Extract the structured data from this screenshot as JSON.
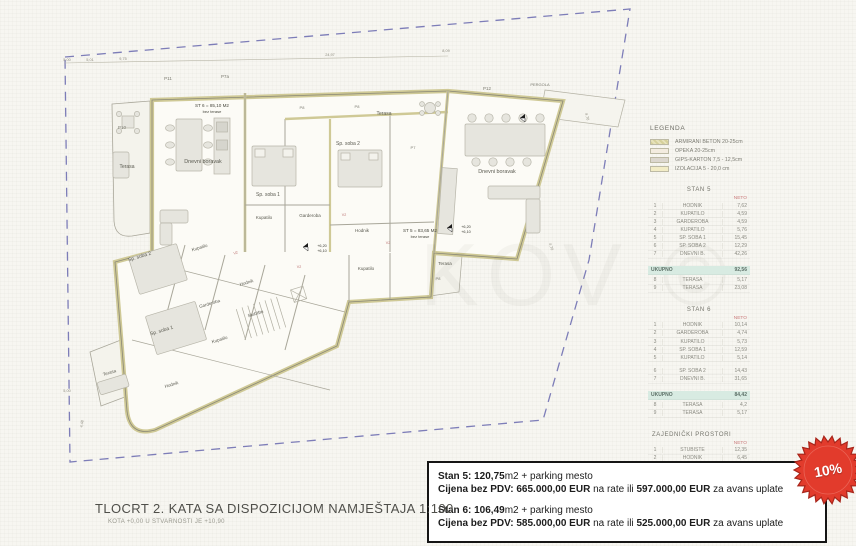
{
  "legend": {
    "title": "LEGENDA",
    "items": [
      {
        "name": "armirani-beton",
        "label": "ARMIRANI BETON 20-25cm"
      },
      {
        "name": "opeka",
        "label": "OPEKA 20-25cm"
      },
      {
        "name": "gips-karton",
        "label": "GIPS-KARTON  7,5 - 12,5cm"
      },
      {
        "name": "izolacija",
        "label": "IZOLACIJA  5 - 20,0 cm"
      }
    ]
  },
  "stan5": {
    "title": "STAN 5",
    "value_header": "NETO",
    "rows": [
      [
        "1",
        "HODNIK",
        "7,62"
      ],
      [
        "2",
        "KUPATILO",
        "4,59"
      ],
      [
        "3",
        "GARDEROBA",
        "4,59"
      ],
      [
        "4",
        "KUPATILO",
        "5,76"
      ],
      [
        "5",
        "SP. SOBA 1",
        "15,45"
      ],
      [
        "6",
        "SP. SOBA 2",
        "12,29"
      ],
      [
        "7",
        "DNEVNI B.",
        "42,26"
      ]
    ],
    "total_label": "UKUPNO",
    "total": "92,56",
    "extra": [
      [
        "8",
        "TERASA",
        "5,17"
      ],
      [
        "9",
        "TERASA",
        "23,08"
      ]
    ]
  },
  "stan6": {
    "title": "STAN 6",
    "value_header": "NETO",
    "rows": [
      [
        "1",
        "HODNIK",
        "10,14"
      ],
      [
        "2",
        "GARDEROBA",
        "4,74"
      ],
      [
        "3",
        "KUPATILO",
        "5,73"
      ],
      [
        "4",
        "SP. SOBA 1",
        "12,59"
      ],
      [
        "5",
        "KUPATILO",
        "5,14"
      ],
      [
        "6",
        "SP. SOBA 2",
        "14,43"
      ],
      [
        "7",
        "DNEVNI B.",
        "31,65"
      ]
    ],
    "total_label": "UKUPNO",
    "total": "84,42",
    "extra": [
      [
        "8",
        "TERASA",
        "4,2"
      ],
      [
        "9",
        "TERASA",
        "5,17"
      ]
    ]
  },
  "zajednicki": {
    "title": "ZAJEDNIČKI PROSTORI",
    "value_header": "NETO",
    "rows": [
      [
        "1",
        "STUBIŠTE",
        "12,35"
      ],
      [
        "2",
        "HODNIK",
        "6,45"
      ],
      [
        "3",
        "DIZALO",
        "3,14"
      ]
    ],
    "total_label": "UKUPNO",
    "total": "21,94"
  },
  "pricing": {
    "s5_l1b": "Stan 5: 120,75",
    "s5_l1r": "m2 + parking mesto",
    "s5_l2b1": "Cijena bez PDV: 665.000,00 EUR",
    "s5_l2r1": " na rate ili ",
    "s5_l2b2": "597.000,00 EUR",
    "s5_l2r2": " za avans uplate",
    "s6_l1b": "Stan 6: 106,49",
    "s6_l1r": "m2 + parking mesto",
    "s6_l2b1": "Cijena bez PDV: 585.000,00 EUR",
    "s6_l2r1": " na rate ili ",
    "s6_l2b2": "525.000,00 EUR",
    "s6_l2r2": " za avans uplate"
  },
  "badge": {
    "text": "10%"
  },
  "footer": {
    "title": "TLOCRT 2. KATA SA DISPOZICIJOM NAMJEŠTAJA 1:100",
    "subtitle": "KOTA +0,00 U STVARNOSTI JE +10,90"
  },
  "watermark": "KOV ©",
  "plan": {
    "labels": [
      "Terasa",
      "P10",
      "Dnevni boravak",
      "ST 6 = 85,10 M2",
      "bez terase",
      "Sp. soba 1",
      "Kupatilo",
      "Sp. soba 2",
      "Garderoba",
      "Hodnik",
      "ST 5 = 83,65 M2",
      "bez terase",
      "Kupatilo",
      "Terasa",
      "P8",
      "Terasa",
      "P8",
      "P8",
      "P7",
      "P11",
      "P7a",
      "P12",
      "PERGOLA",
      "Dnevni boravak",
      "Sp. soba 2",
      "Kupatilo",
      "Garderoba",
      "Hodnik",
      "Sp. soba 1",
      "Kupatilo",
      "Stubište",
      "Hodnik",
      "Terasa",
      "+6,20",
      "+6,10",
      "+6,20",
      "+6,10",
      "5,00",
      "5,01",
      "9,75",
      "24,97",
      "8,09",
      "4,70",
      "4,70",
      "5,00",
      "4,48",
      "V2",
      "V2",
      "V2",
      "V2"
    ]
  }
}
